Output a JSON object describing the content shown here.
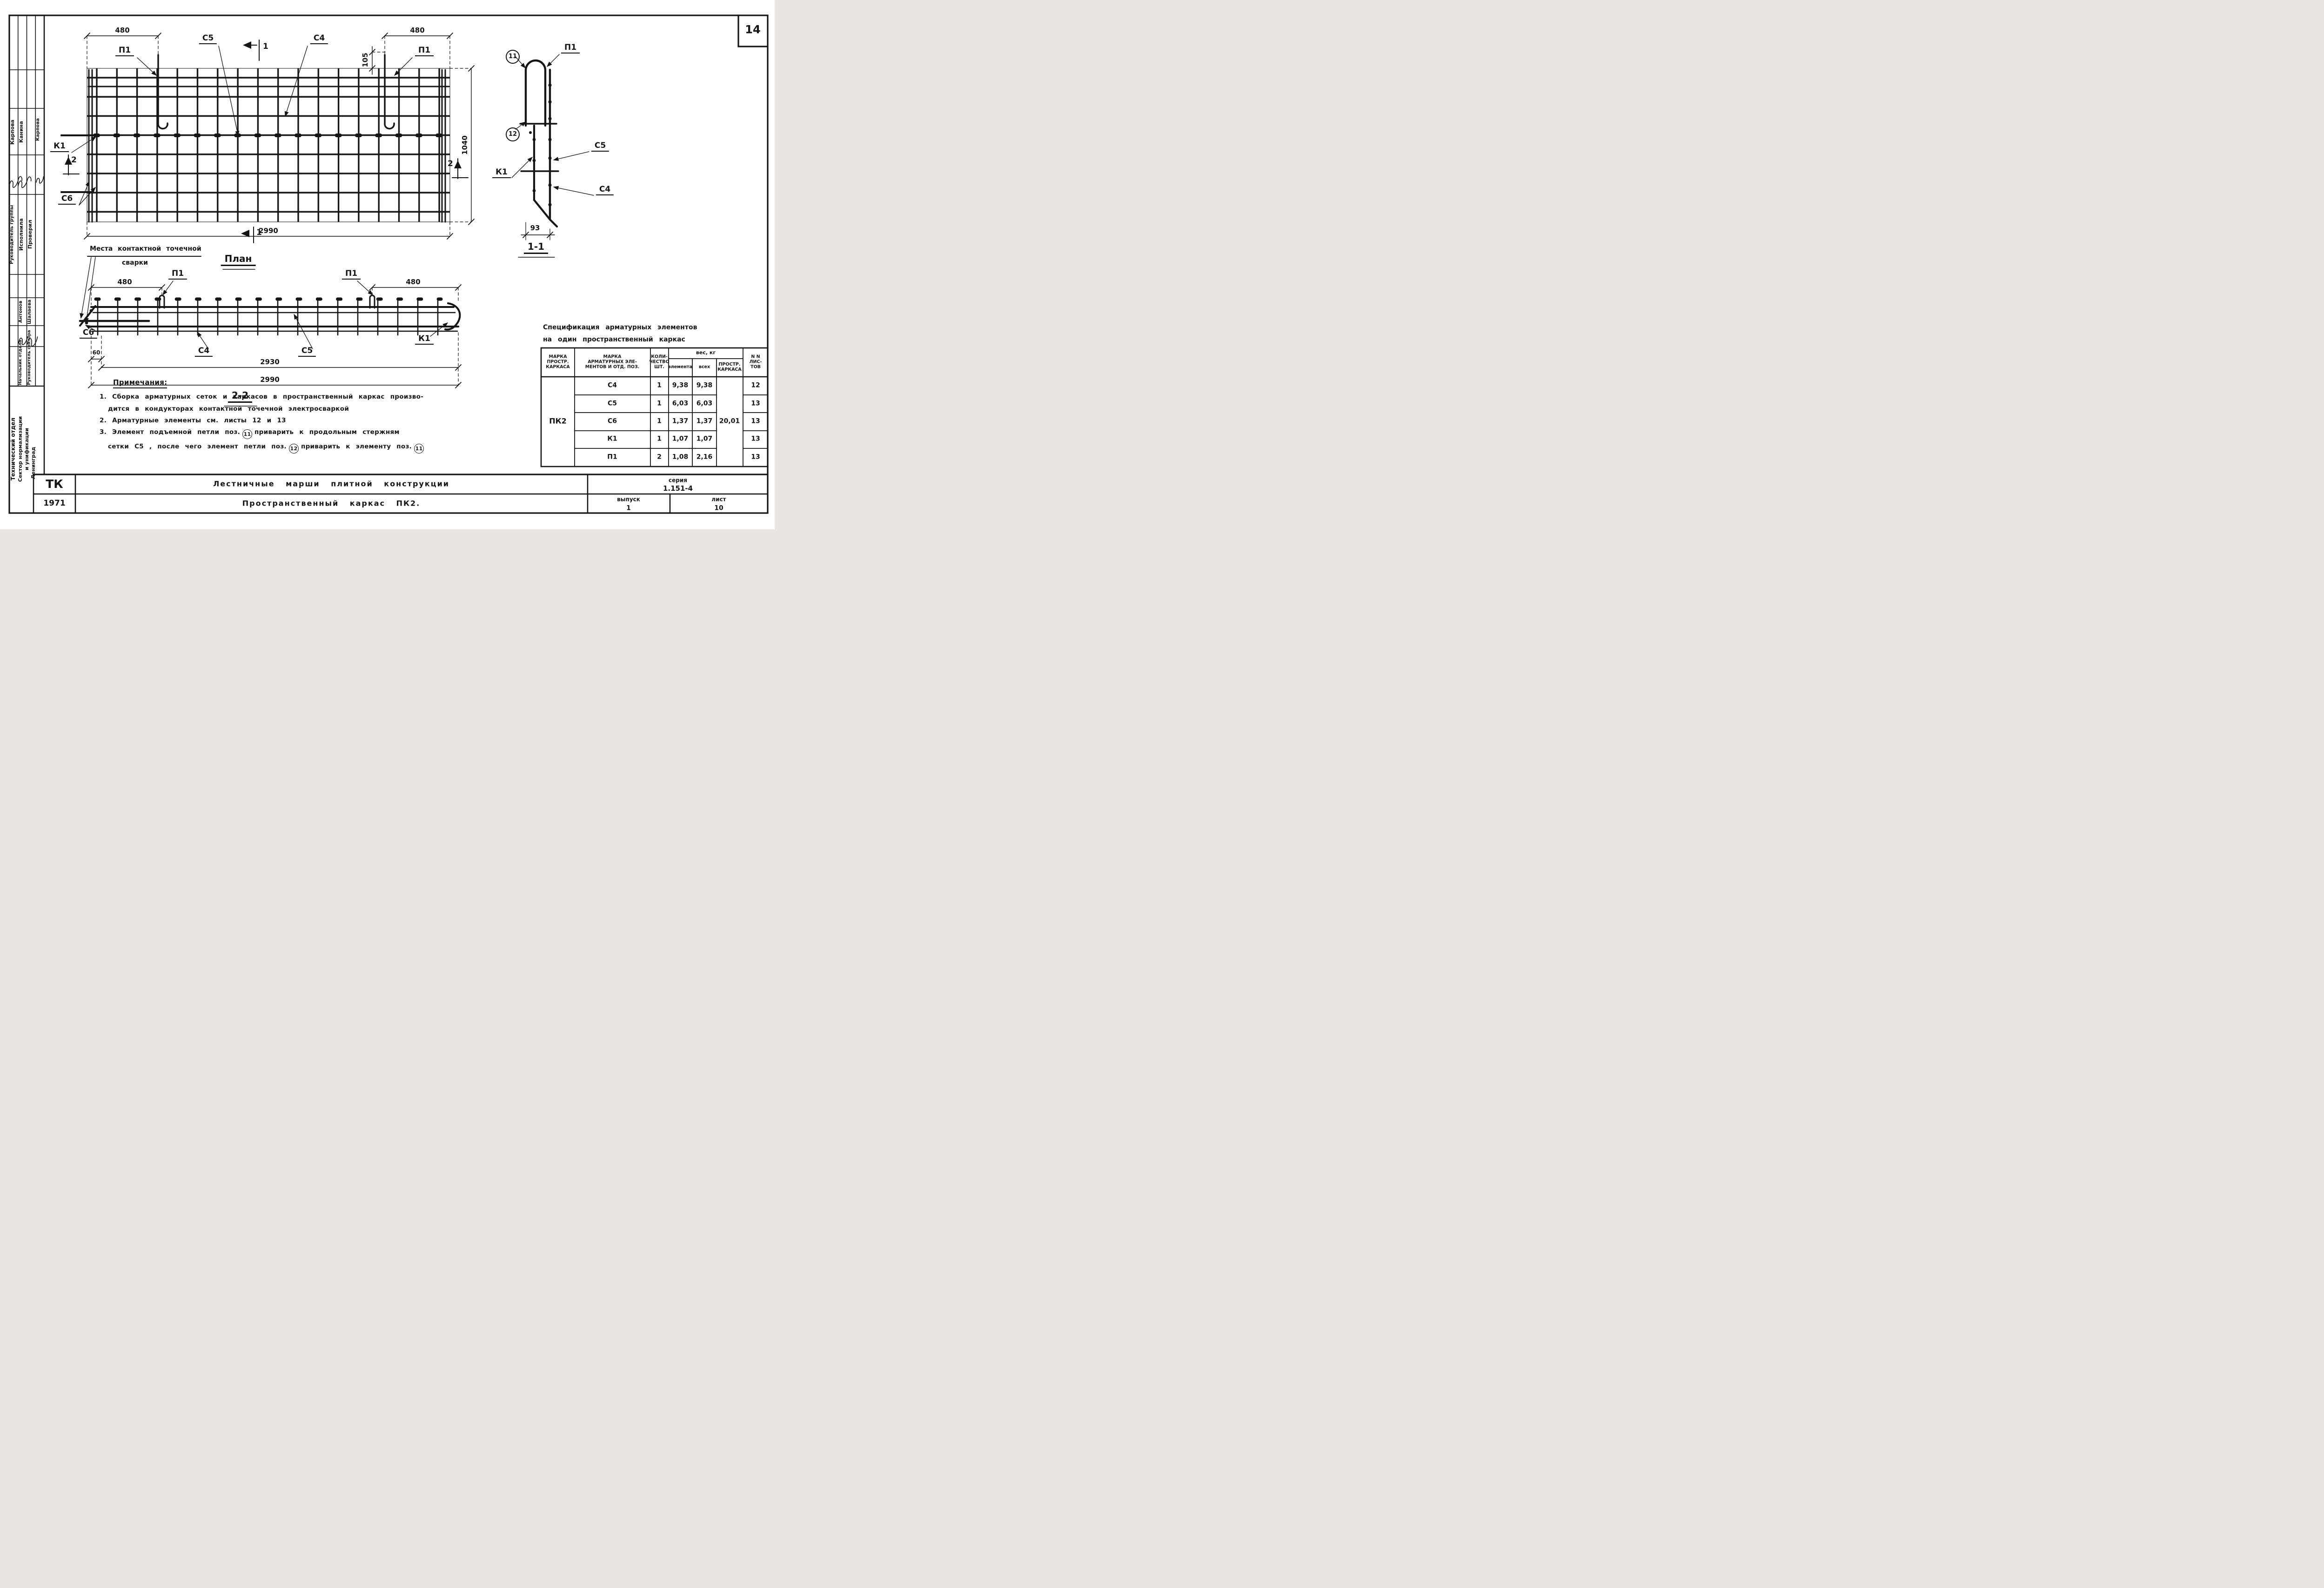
{
  "sheet": {
    "page_number": "14"
  },
  "plan": {
    "title": "План",
    "weld_note_line1": "Места контактной точечной",
    "weld_note_line2": "сварки",
    "dim_480_left": "480",
    "dim_480_right": "480",
    "dim_105": "105",
    "dim_1040": "1040",
    "dim_2990": "2990",
    "label_p1_left": "П1",
    "label_p1_right": "П1",
    "label_c5": "С5",
    "label_c4": "С4",
    "label_k1": "К1",
    "label_c6": "С6",
    "mark_1_top": "1",
    "mark_1_bottom": "1",
    "mark_2_left": "2",
    "mark_2_right": "2"
  },
  "section22": {
    "title": "2-2",
    "dim_480_left": "480",
    "dim_480_right": "480",
    "dim_60": "60",
    "dim_2930": "2930",
    "dim_2990": "2990",
    "label_p1_left": "П1",
    "label_p1_right": "П1",
    "label_c6": "С6",
    "label_c4": "С4",
    "label_c5": "С5",
    "label_k1": "К1"
  },
  "section11": {
    "title": "1-1",
    "dim_93": "93",
    "pos_11": "11",
    "pos_12": "12",
    "label_p1": "П1",
    "label_c5": "С5",
    "label_k1": "К1",
    "label_c4": "С4"
  },
  "spec": {
    "title_line1": "Спецификация арматурных элементов",
    "title_line2": "на один пространственный каркас",
    "headers": {
      "mark_frame": "МАРКА\nПРОСТР.\nКАРКАСА",
      "mark_elements": "МАРКА\nАРМАТУРНЫХ ЭЛЕ-\nМЕНТОВ И ОТД. ПОЗ.",
      "qty": "КОЛИ-\nЧЕСТВО\nШТ.",
      "weight_group": "вес, кг",
      "weight_element": "элемента",
      "weight_all": "всех",
      "weight_frame": "ПРОСТР.\nКАРКАСА",
      "sheets": "N N\nЛИС-\nТОВ"
    },
    "frame_mark": "ПК2",
    "frame_weight": "20,01",
    "rows": [
      {
        "mark": "С4",
        "qty": "1",
        "w_el": "9,38",
        "w_all": "9,38",
        "sheet": "12"
      },
      {
        "mark": "С5",
        "qty": "1",
        "w_el": "6,03",
        "w_all": "6,03",
        "sheet": "13"
      },
      {
        "mark": "С6",
        "qty": "1",
        "w_el": "1,37",
        "w_all": "1,37",
        "sheet": "13"
      },
      {
        "mark": "К1",
        "qty": "1",
        "w_el": "1,07",
        "w_all": "1,07",
        "sheet": "13"
      },
      {
        "mark": "П1",
        "qty": "2",
        "w_el": "1,08",
        "w_all": "2,16",
        "sheet": "13"
      }
    ]
  },
  "notes": {
    "heading": "Примечания:",
    "n1_line1": "1. Сборка арматурных сеток и каркасов в пространственный каркас произво-",
    "n1_line2": "дится в кондукторах контактной точечной электросваркой",
    "n2": "2. Арматурные элементы см. листы 12 и 13",
    "n3_line1_pre": "3. Элемент подъемной петли поз.",
    "n3_pos11a": "11",
    "n3_line1_post": "приварить к продольным стержням",
    "n3_line2_pre": "сетки С5 , после чего элемент петли поз.",
    "n3_pos12": "12",
    "n3_line2_mid": "приварить к элементу поз.",
    "n3_pos11b": "11"
  },
  "title_block": {
    "org_code": "ТК",
    "year": "1971",
    "title_line1": "Лестничные марши плитной конструкции",
    "title_line2": "Пространственный каркас ПК2.",
    "series_label": "серия",
    "series_value": "1.151-4",
    "issue_label": "выпуск",
    "issue_value": "1",
    "sheet_label": "лист",
    "sheet_value": "10"
  },
  "sidebar": {
    "name_group_lead": "Карпова",
    "name_executor": "Канина",
    "name_checker": "Карпова",
    "role_group_lead": "Руководитель группы",
    "role_executor": "Исполнила",
    "role_checker": "Проверил",
    "name_head_dept": "Антонов",
    "name_head_sector": "Шалаева",
    "role_head_dept": "Начальник отдела",
    "role_head_sector": "Руководитель сектора",
    "org_line1": "Технический отдел",
    "org_line2": "Сектор нормализации",
    "org_line3": "и унификации",
    "org_city": "Ленинград"
  }
}
